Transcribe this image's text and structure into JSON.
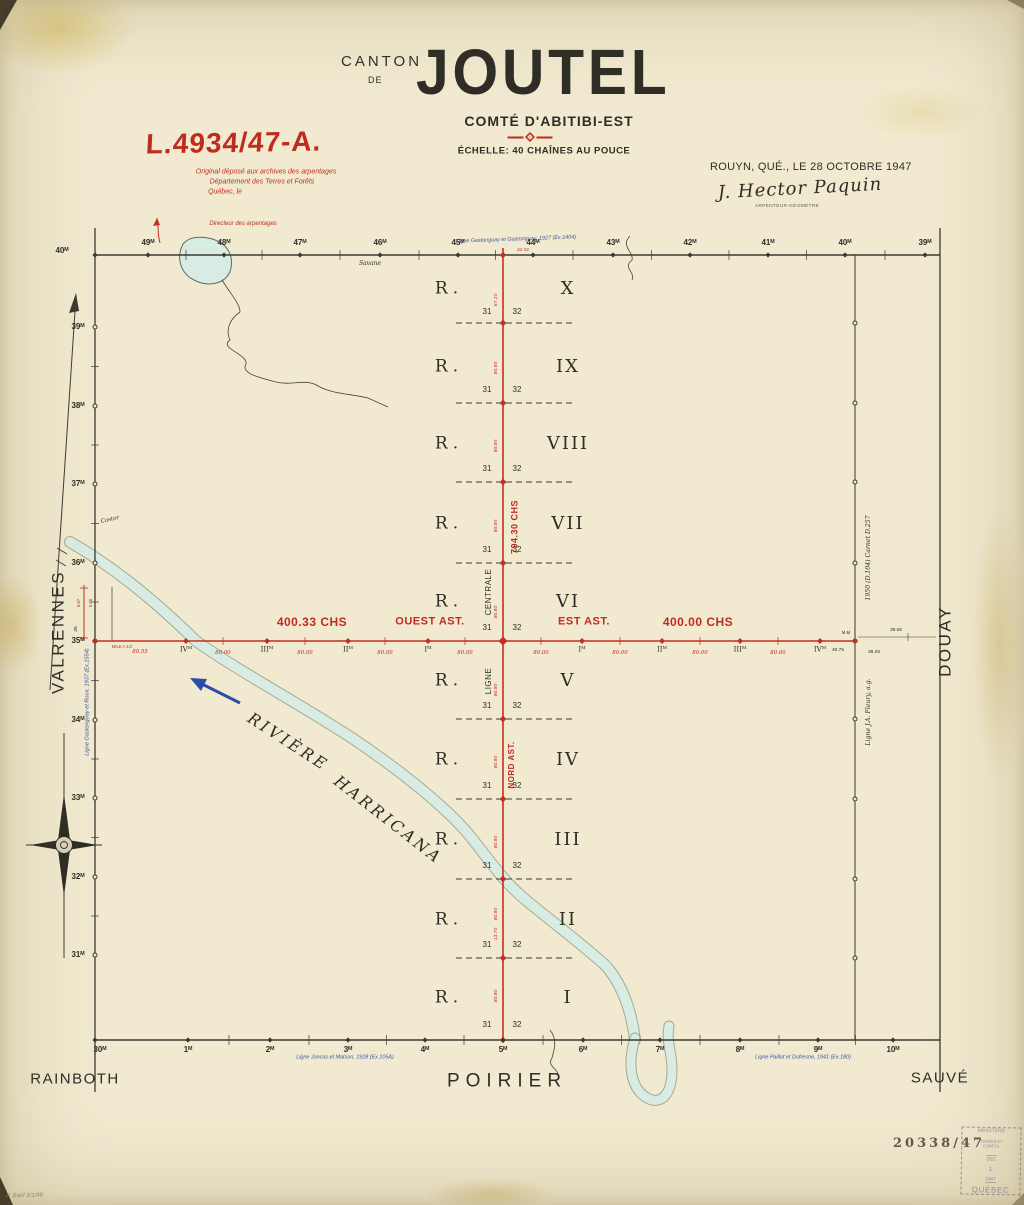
{
  "colors": {
    "red": "#bf2c1e",
    "blue": "#3d56a3",
    "ink": "#2e2e26",
    "river": "#d9ece4",
    "paper": "#f1ead0"
  },
  "title": {
    "canton": "CANTON",
    "de": "DE",
    "name": "JOUTEL",
    "county": "COMTÉ D'ABITIBI-EST",
    "scale": "ÉCHELLE: 40 CHAÎNES AU POUCE"
  },
  "archive_stamp": {
    "number": "L.4934/47-A.",
    "line1": "Original déposé aux archives des arpentages",
    "line2": "Département des Terres et Forêts",
    "line3": "Québec, le",
    "director": "Directeur des arpentages"
  },
  "certification": {
    "place_date": "ROUYN, QUÉ., LE 28 OCTOBRE 1947",
    "signature": "J. Hector Paquin",
    "title": "ARPENTEUR-GÉOMÈTRE"
  },
  "neighbors": {
    "west": "VALRENNES",
    "east": "DOUAY",
    "south": "POIRIER",
    "southwest": "RAINBOTH",
    "southeast": "SAUVÉ"
  },
  "river": {
    "word1": "RIVIÈRE",
    "word2": "HARRICANA"
  },
  "center_line": {
    "total": "794.30 CHS",
    "centrale": "CENTRALE",
    "ligne": "LIGNE",
    "nord": "NORD AST.",
    "extra_chain": "13.70"
  },
  "base_line": {
    "west_length": "400.33 CHS",
    "west_name": "OUEST AST.",
    "east_name": "EST AST.",
    "east_length": "400.00 CHS",
    "first_segment": "80.55",
    "segment": "80.00",
    "west_posts": [
      "IVᴹ",
      "IIIᴹ",
      "IIᴹ",
      "Iᴹ"
    ],
    "east_posts": [
      "Iᴹ",
      "IIᴹ",
      "IIIᴹ",
      "IVᴹ"
    ],
    "east_extras": [
      "40.75",
      "38.25",
      "39.06"
    ],
    "mm": "M.M",
    "mile_note": "MILE A 1/2"
  },
  "ranges": [
    {
      "prefix": "R.",
      "numeral": "X",
      "lot_left": "31",
      "lot_right": "32",
      "chain": "67.10"
    },
    {
      "prefix": "R.",
      "numeral": "IX",
      "lot_left": "31",
      "lot_right": "32",
      "chain": "80.80"
    },
    {
      "prefix": "R.",
      "numeral": "VIII",
      "lot_left": "31",
      "lot_right": "32",
      "chain": "80.80"
    },
    {
      "prefix": "R.",
      "numeral": "VII",
      "lot_left": "31",
      "lot_right": "32",
      "chain": "80.80"
    },
    {
      "prefix": "R.",
      "numeral": "VI",
      "lot_left": "31",
      "lot_right": "32",
      "chain": "80.80"
    },
    {
      "prefix": "R.",
      "numeral": "V",
      "lot_left": "31",
      "lot_right": "32",
      "chain": "80.80"
    },
    {
      "prefix": "R.",
      "numeral": "IV",
      "lot_left": "31",
      "lot_right": "32",
      "chain": "80.80"
    },
    {
      "prefix": "R.",
      "numeral": "III",
      "lot_left": "31",
      "lot_right": "32",
      "chain": "80.80"
    },
    {
      "prefix": "R.",
      "numeral": "II",
      "lot_left": "31",
      "lot_right": "32",
      "chain": "80.80"
    },
    {
      "prefix": "R.",
      "numeral": "I",
      "lot_left": "31",
      "lot_right": "32",
      "chain": "80.80"
    }
  ],
  "edge_miles": {
    "top": [
      "40ᴹ",
      "49ᴹ",
      "48ᴹ",
      "47ᴹ",
      "46ᴹ",
      "45ᴹ",
      "44ᴹ",
      "43ᴹ",
      "42ᴹ",
      "41ᴹ",
      "40ᴹ",
      "39ᴹ"
    ],
    "left": [
      "39ᴹ",
      "38ᴹ",
      "37ᴹ",
      "36ᴹ",
      "35ᴹ",
      "34ᴹ",
      "33ᴹ",
      "32ᴹ",
      "31ᴹ"
    ],
    "bottom": [
      "30ᴹ",
      "1ᴹ",
      "2ᴹ",
      "3ᴹ",
      "4ᴹ",
      "5ᴹ",
      "6ᴹ",
      "7ᴹ",
      "8ᴹ",
      "9ᴹ",
      "10ᴹ"
    ]
  },
  "survey_lines": {
    "north": "Ligne Gastonguay et Gastonguay, 1927 (Ex.1404)",
    "west": "Ligne Gastonguay et Roux, 1937 (Ex.1554)",
    "south_west": "Ligne Joncas et Matson, 1928 (Ex.105A)",
    "south_east": "Ligne Paillot et Dufresne, 1941 (Ex.180)",
    "east_upper": "1950 (D.104) Carnet D.257",
    "east_lower": "Ligne J.A. Fleury, a.g."
  },
  "annotations": {
    "savane": "Savane",
    "castor": "Castor",
    "junction": "31-31",
    "left_val1": "5.87",
    "left_val2": "5.88",
    "left_mile": "35"
  },
  "file_number": "20338/47",
  "ministry_stamp": {
    "l1": "MINISTÈRE",
    "l2": "TERRES ET FORÊTS",
    "l3": "DEC",
    "l4": "1",
    "l5": "1947",
    "l6": "QUÉBEC"
  },
  "corner_note": "P. Baril  3/1/48"
}
